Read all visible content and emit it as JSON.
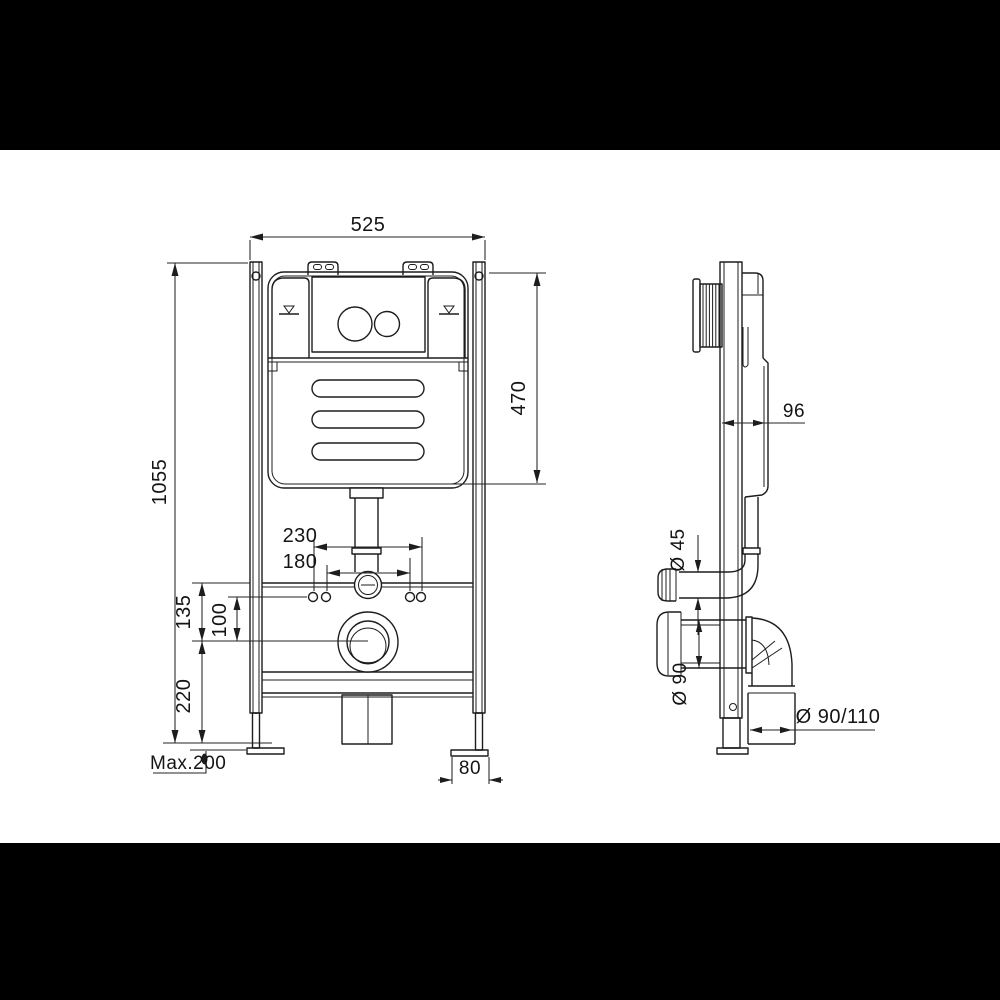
{
  "colors": {
    "line": "#1d1d1d",
    "background": "#ffffff",
    "letterbox": "#000000"
  },
  "front_view": {
    "dims": {
      "overall_width": "525",
      "overall_height": "1055",
      "tank_height": "470",
      "fixing_span_outer": "230",
      "fixing_span_inner": "180",
      "rail_to_outlet": "135",
      "fixing_to_outlet": "100",
      "outlet_height": "220",
      "foot_adjustment": "Max.200",
      "foot_plate_width": "80"
    }
  },
  "side_view": {
    "dims": {
      "frame_depth": "96",
      "flush_pipe_diameter": "Ø 45",
      "outlet_diameter": "Ø 90",
      "drain_pipe_diameter": "Ø 90/110"
    }
  }
}
